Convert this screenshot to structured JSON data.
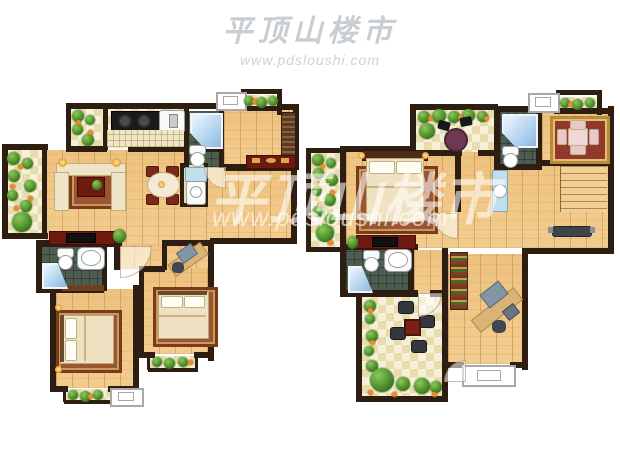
{
  "image": {
    "type": "real-estate floor plan rendering",
    "plans": 2
  },
  "watermark_top": {
    "title": "平顶山楼市",
    "url": "www.pdsloushi.com"
  },
  "watermark_center": {
    "title": "平顶山楼市",
    "url": "www.pdsloushi.com"
  },
  "palette": {
    "background": "#ffffff",
    "wall": "#2e1d11",
    "wood_floor": "#eec27f",
    "tile_light": "#f6f0d8",
    "tile_dark": "#e6dcae",
    "bathroom_tile": "#4d5d52",
    "shower_blue": "#a8cdec",
    "furniture_red": "#6e1a10",
    "sofa_cream": "#efe4c6",
    "rug_red": "#9a5532",
    "plant_green": "#4e8f2b",
    "flower_orange": "#e78c28",
    "watermark_white": "rgba(255,255,255,0.58)",
    "watermark_gray": "#c9ced2"
  }
}
